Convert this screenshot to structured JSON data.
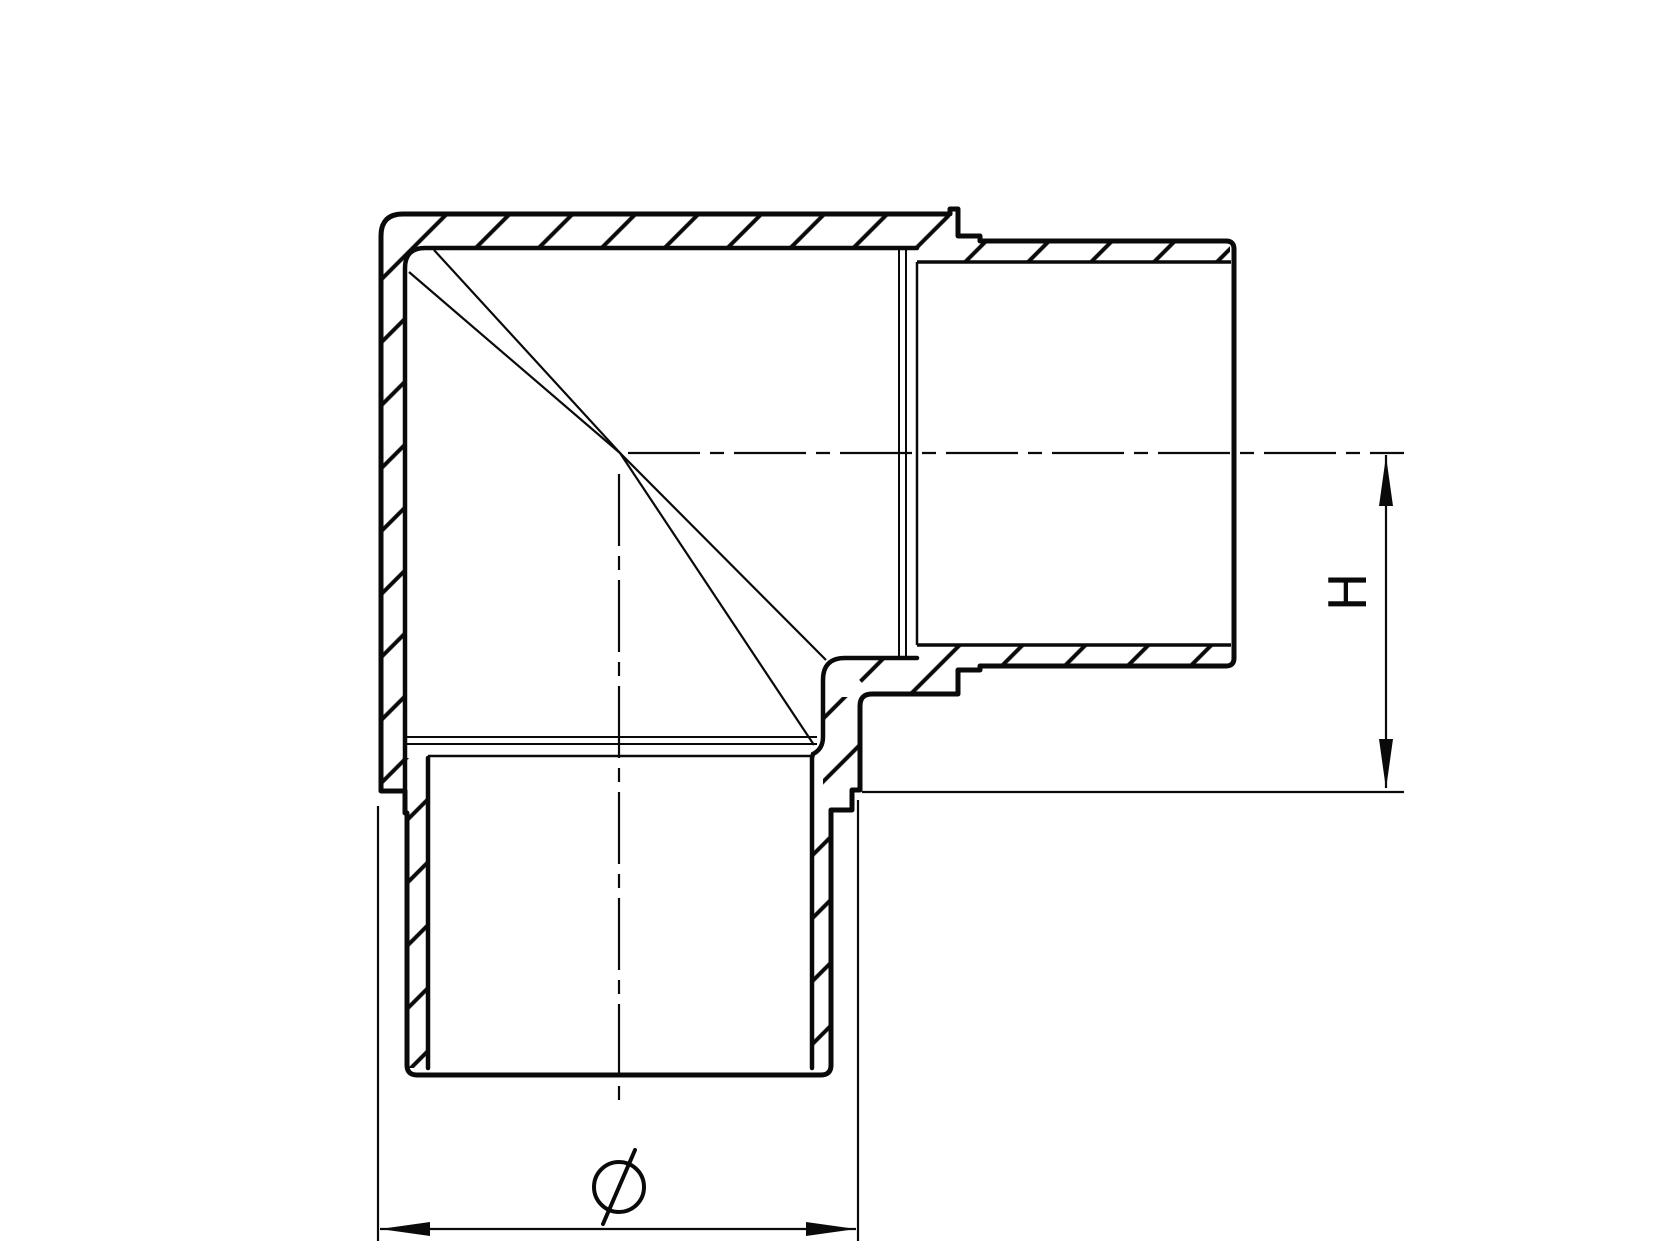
{
  "drawing": {
    "background": "#ffffff",
    "line_color": "#0a0a0a",
    "labels": {
      "height": "H",
      "diameter": "Ø"
    }
  }
}
